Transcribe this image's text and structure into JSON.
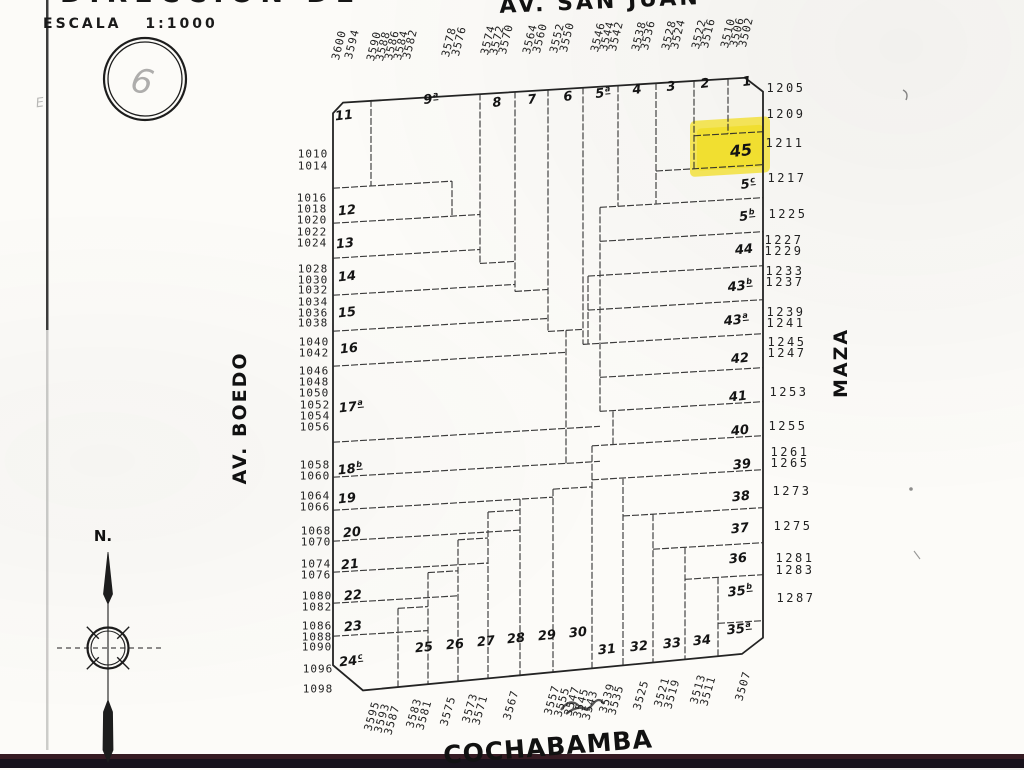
{
  "title_fragment": "DIRECCION DE",
  "scale_label": "ESCALA 1:1000",
  "stamp_digit": "6",
  "margin_mark": "E",
  "compass": {
    "north_label": "N."
  },
  "streets": {
    "top": "AV. SAN JUAN",
    "left": "AV. BOEDO",
    "right": "MAZA",
    "bottom": "COCHABAMBA"
  },
  "highlight": {
    "parcel": "45",
    "color": "#f2de24"
  },
  "street_numbers": {
    "top": [
      {
        "t": "3600",
        "x": 339,
        "y": 45
      },
      {
        "t": "3594",
        "x": 352,
        "y": 44
      },
      {
        "t": "3590",
        "x": 374,
        "y": 46
      },
      {
        "t": "3588",
        "x": 383,
        "y": 46
      },
      {
        "t": "3586",
        "x": 392,
        "y": 45
      },
      {
        "t": "3584",
        "x": 401,
        "y": 45
      },
      {
        "t": "3582",
        "x": 410,
        "y": 44
      },
      {
        "t": "3578",
        "x": 449,
        "y": 42
      },
      {
        "t": "3576",
        "x": 459,
        "y": 41
      },
      {
        "t": "3574",
        "x": 488,
        "y": 40
      },
      {
        "t": "3572",
        "x": 497,
        "y": 40
      },
      {
        "t": "3570",
        "x": 506,
        "y": 39
      },
      {
        "t": "3564",
        "x": 530,
        "y": 39
      },
      {
        "t": "3560",
        "x": 540,
        "y": 38
      },
      {
        "t": "3552",
        "x": 557,
        "y": 38
      },
      {
        "t": "3550",
        "x": 567,
        "y": 37
      },
      {
        "t": "3546",
        "x": 598,
        "y": 37
      },
      {
        "t": "3544",
        "x": 607,
        "y": 36
      },
      {
        "t": "3542",
        "x": 616,
        "y": 36
      },
      {
        "t": "3538",
        "x": 639,
        "y": 36
      },
      {
        "t": "3536",
        "x": 648,
        "y": 35
      },
      {
        "t": "3528",
        "x": 669,
        "y": 35
      },
      {
        "t": "3524",
        "x": 678,
        "y": 34
      },
      {
        "t": "3522",
        "x": 699,
        "y": 34
      },
      {
        "t": "3516",
        "x": 708,
        "y": 33
      },
      {
        "t": "3510",
        "x": 728,
        "y": 33
      },
      {
        "t": "3506",
        "x": 737,
        "y": 32
      },
      {
        "t": "3502",
        "x": 746,
        "y": 32
      }
    ],
    "left": [
      {
        "t": "1010",
        "x": 313,
        "y": 154
      },
      {
        "t": "1014",
        "x": 313,
        "y": 166
      },
      {
        "t": "1016",
        "x": 312,
        "y": 198
      },
      {
        "t": "1018",
        "x": 312,
        "y": 209
      },
      {
        "t": "1020",
        "x": 312,
        "y": 220
      },
      {
        "t": "1022",
        "x": 312,
        "y": 232
      },
      {
        "t": "1024",
        "x": 312,
        "y": 243
      },
      {
        "t": "1028",
        "x": 313,
        "y": 269
      },
      {
        "t": "1030",
        "x": 313,
        "y": 280
      },
      {
        "t": "1032",
        "x": 313,
        "y": 290
      },
      {
        "t": "1034",
        "x": 313,
        "y": 302
      },
      {
        "t": "1036",
        "x": 313,
        "y": 313
      },
      {
        "t": "1038",
        "x": 313,
        "y": 323
      },
      {
        "t": "1040",
        "x": 314,
        "y": 342
      },
      {
        "t": "1042",
        "x": 314,
        "y": 353
      },
      {
        "t": "1046",
        "x": 314,
        "y": 371
      },
      {
        "t": "1048",
        "x": 314,
        "y": 382
      },
      {
        "t": "1050",
        "x": 314,
        "y": 393
      },
      {
        "t": "1052",
        "x": 315,
        "y": 405
      },
      {
        "t": "1054",
        "x": 315,
        "y": 416
      },
      {
        "t": "1056",
        "x": 315,
        "y": 427
      },
      {
        "t": "1058",
        "x": 315,
        "y": 465
      },
      {
        "t": "1060",
        "x": 315,
        "y": 476
      },
      {
        "t": "1064",
        "x": 315,
        "y": 496
      },
      {
        "t": "1066",
        "x": 315,
        "y": 507
      },
      {
        "t": "1068",
        "x": 316,
        "y": 531
      },
      {
        "t": "1070",
        "x": 316,
        "y": 542
      },
      {
        "t": "1074",
        "x": 316,
        "y": 564
      },
      {
        "t": "1076",
        "x": 316,
        "y": 575
      },
      {
        "t": "1080",
        "x": 317,
        "y": 596
      },
      {
        "t": "1082",
        "x": 317,
        "y": 607
      },
      {
        "t": "1086",
        "x": 317,
        "y": 626
      },
      {
        "t": "1088",
        "x": 317,
        "y": 637
      },
      {
        "t": "1090",
        "x": 317,
        "y": 647
      },
      {
        "t": "1096",
        "x": 318,
        "y": 669
      },
      {
        "t": "1098",
        "x": 318,
        "y": 689
      }
    ],
    "right": [
      {
        "t": "1205",
        "x": 786,
        "y": 88
      },
      {
        "t": "1209",
        "x": 786,
        "y": 114
      },
      {
        "t": "1211",
        "x": 785,
        "y": 143
      },
      {
        "t": "1217",
        "x": 787,
        "y": 178
      },
      {
        "t": "1225",
        "x": 788,
        "y": 214
      },
      {
        "t": "1227",
        "x": 784,
        "y": 240
      },
      {
        "t": "1229",
        "x": 784,
        "y": 251
      },
      {
        "t": "1233",
        "x": 785,
        "y": 271
      },
      {
        "t": "1237",
        "x": 785,
        "y": 282
      },
      {
        "t": "1239",
        "x": 786,
        "y": 312
      },
      {
        "t": "1241",
        "x": 786,
        "y": 323
      },
      {
        "t": "1245",
        "x": 787,
        "y": 342
      },
      {
        "t": "1247",
        "x": 787,
        "y": 353
      },
      {
        "t": "1253",
        "x": 789,
        "y": 392
      },
      {
        "t": "1255",
        "x": 788,
        "y": 426
      },
      {
        "t": "1261",
        "x": 790,
        "y": 452
      },
      {
        "t": "1265",
        "x": 790,
        "y": 463
      },
      {
        "t": "1273",
        "x": 792,
        "y": 491
      },
      {
        "t": "1275",
        "x": 793,
        "y": 526
      },
      {
        "t": "1281",
        "x": 795,
        "y": 558
      },
      {
        "t": "1283",
        "x": 795,
        "y": 570
      },
      {
        "t": "1287",
        "x": 796,
        "y": 598
      }
    ],
    "bottom": [
      {
        "t": "3595",
        "x": 372,
        "y": 716
      },
      {
        "t": "3593",
        "x": 382,
        "y": 718
      },
      {
        "t": "3587",
        "x": 392,
        "y": 720
      },
      {
        "t": "3583",
        "x": 414,
        "y": 713
      },
      {
        "t": "3581",
        "x": 424,
        "y": 715
      },
      {
        "t": "3575",
        "x": 448,
        "y": 711
      },
      {
        "t": "3573",
        "x": 470,
        "y": 708
      },
      {
        "t": "3571",
        "x": 480,
        "y": 710
      },
      {
        "t": "3567",
        "x": 511,
        "y": 705
      },
      {
        "t": "3557",
        "x": 552,
        "y": 700
      },
      {
        "t": "3555",
        "x": 562,
        "y": 702
      },
      {
        "t": "3547",
        "x": 572,
        "y": 701
      },
      {
        "t": "3545",
        "x": 581,
        "y": 703
      },
      {
        "t": "3543",
        "x": 590,
        "y": 705
      },
      {
        "t": "3539",
        "x": 607,
        "y": 698
      },
      {
        "t": "3535",
        "x": 616,
        "y": 700
      },
      {
        "t": "3525",
        "x": 641,
        "y": 695
      },
      {
        "t": "3521",
        "x": 662,
        "y": 692
      },
      {
        "t": "3519",
        "x": 672,
        "y": 694
      },
      {
        "t": "3513",
        "x": 698,
        "y": 689
      },
      {
        "t": "3511",
        "x": 708,
        "y": 691
      },
      {
        "t": "3507",
        "x": 743,
        "y": 686
      }
    ]
  },
  "parcels": [
    {
      "t": "11",
      "x": 344,
      "y": 116
    },
    {
      "t": "9",
      "sup": "a",
      "x": 431,
      "y": 99
    },
    {
      "t": "8",
      "x": 497,
      "y": 103
    },
    {
      "t": "7",
      "x": 532,
      "y": 100
    },
    {
      "t": "6",
      "x": 568,
      "y": 97
    },
    {
      "t": "5",
      "sup": "a",
      "x": 603,
      "y": 93
    },
    {
      "t": "4",
      "x": 637,
      "y": 90
    },
    {
      "t": "3",
      "x": 671,
      "y": 87
    },
    {
      "t": "2",
      "x": 705,
      "y": 84
    },
    {
      "t": "1",
      "x": 747,
      "y": 82
    },
    {
      "t": "45",
      "x": 741,
      "y": 151,
      "big": true
    },
    {
      "t": "5",
      "sup": "c",
      "x": 748,
      "y": 184
    },
    {
      "t": "5",
      "sup": "b",
      "x": 747,
      "y": 216
    },
    {
      "t": "44",
      "x": 744,
      "y": 250
    },
    {
      "t": "43",
      "sup": "b",
      "x": 740,
      "y": 286
    },
    {
      "t": "43",
      "sup": "a",
      "x": 736,
      "y": 320
    },
    {
      "t": "42",
      "x": 740,
      "y": 359
    },
    {
      "t": "41",
      "x": 738,
      "y": 397
    },
    {
      "t": "40",
      "x": 740,
      "y": 431
    },
    {
      "t": "39",
      "x": 742,
      "y": 465
    },
    {
      "t": "38",
      "x": 741,
      "y": 497
    },
    {
      "t": "37",
      "x": 740,
      "y": 529
    },
    {
      "t": "36",
      "x": 738,
      "y": 559
    },
    {
      "t": "35",
      "sup": "b",
      "x": 740,
      "y": 591
    },
    {
      "t": "35",
      "sup": "a",
      "x": 739,
      "y": 629
    },
    {
      "t": "12",
      "x": 347,
      "y": 211
    },
    {
      "t": "13",
      "x": 345,
      "y": 244
    },
    {
      "t": "14",
      "x": 347,
      "y": 277
    },
    {
      "t": "15",
      "x": 347,
      "y": 313
    },
    {
      "t": "16",
      "x": 349,
      "y": 349
    },
    {
      "t": "17",
      "sup": "a",
      "x": 351,
      "y": 407
    },
    {
      "t": "18",
      "sup": "b",
      "x": 350,
      "y": 469
    },
    {
      "t": "19",
      "x": 347,
      "y": 499
    },
    {
      "t": "20",
      "x": 352,
      "y": 533
    },
    {
      "t": "21",
      "x": 350,
      "y": 565
    },
    {
      "t": "22",
      "x": 353,
      "y": 596
    },
    {
      "t": "23",
      "x": 353,
      "y": 627
    },
    {
      "t": "24",
      "sup": "c",
      "x": 351,
      "y": 661
    },
    {
      "t": "25",
      "x": 424,
      "y": 648
    },
    {
      "t": "26",
      "x": 455,
      "y": 645
    },
    {
      "t": "27",
      "x": 486,
      "y": 642
    },
    {
      "t": "28",
      "x": 516,
      "y": 639
    },
    {
      "t": "29",
      "x": 547,
      "y": 636
    },
    {
      "t": "30",
      "x": 578,
      "y": 633
    },
    {
      "t": "31",
      "x": 607,
      "y": 650
    },
    {
      "t": "32",
      "x": 639,
      "y": 647
    },
    {
      "t": "33",
      "x": 672,
      "y": 644
    },
    {
      "t": "34",
      "x": 702,
      "y": 641
    }
  ]
}
